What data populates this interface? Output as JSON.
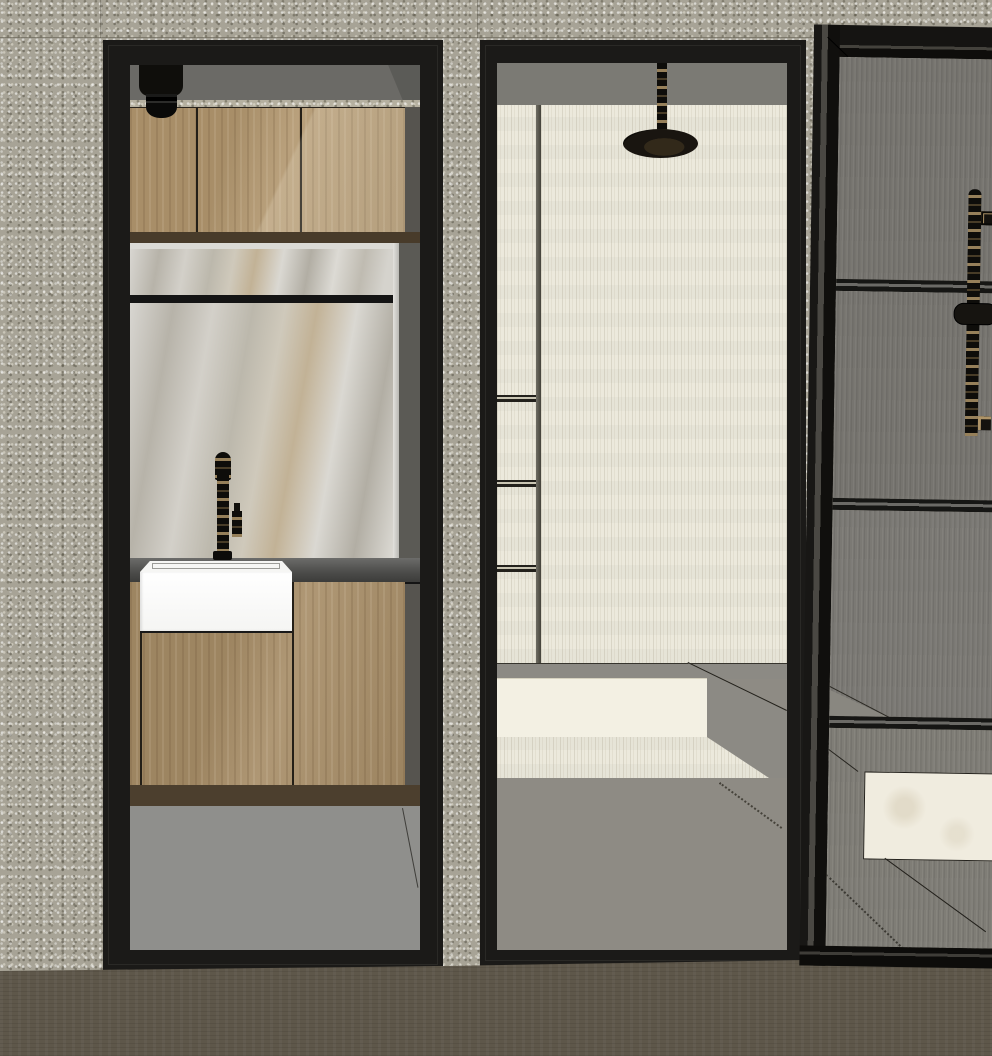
{
  "meta": {
    "kind": "3d-interior-render",
    "style": "SketchUp-like bathroom elevation with two wall openings and a glass partition",
    "width_px": 992,
    "height_px": 1056
  },
  "palette": {
    "wall": "#a7a396",
    "wall-light": "#b5b0a0",
    "frame": "#1b1a18",
    "frame-bevel": "#3a3833",
    "ceiling": "#6b6a66",
    "wood": "#b2976f",
    "wood-dark": "#a78d67",
    "brown-band": "#483b2a",
    "toe-band": "#4c3f2e",
    "mirror-edge": "#dbdad5",
    "marble": "#cdcac3",
    "black-bar": "#141414",
    "counter": "#4e4e4c",
    "counter-hi": "#6c6c6a",
    "sink": "#fdfdfd",
    "under-vanity": "#8f8f8c",
    "sliver": "#56544f",
    "header-gray": "#7b7a74",
    "travertine": "#ebe8db",
    "platform-bright": "#f3f0e3",
    "platform-gray": "#8c8a84",
    "shower-floor": "#8e8b84",
    "glass": "#76746f",
    "glass-lower": "#7b7974",
    "bench": "#f0ecdf",
    "fixture-black": "#0f0e0b",
    "accent-tan": "#ae9468",
    "exterior-floor": "#5e574a"
  },
  "objects": {
    "wall": "Speckled concrete feature wall",
    "pillar": "Concrete pillar between openings",
    "vanity_doorway": "Vanity niche doorway with black frame",
    "ceiling_light": "Black cylindrical downlight",
    "upper_cabinets": "Timber overhead cabinets (3 doors)",
    "splashback": "Marble mirror / splashback panel",
    "black_shelf": "Black shelf rail across marble",
    "faucet": "Matte black gooseneck mixer tap",
    "sink": "White wall-hung rectangular basin",
    "counter": "Dark stone vanity counter edge",
    "vanity_cabinets": "Timber wall-hung vanity cabinets",
    "shower_doorway": "Walk-in shower doorway with black frame",
    "shower_header": "Grey bulkhead above shower",
    "niche_shelves": "Recessed shower niche with shelves",
    "shower_wall": "Cream travertine shower wall",
    "rain_shower": "Ceiling-mounted black rain shower head",
    "platform_step": "Stone shower platform step",
    "shower_floor": "Grey shower floor",
    "glass_partition": "Black-framed smoked glass partition",
    "slider_rail": "Hand-shower slider rail behind glass",
    "bench": "White marble bench slab",
    "exterior_floor": "Grey screed floor in foreground"
  }
}
